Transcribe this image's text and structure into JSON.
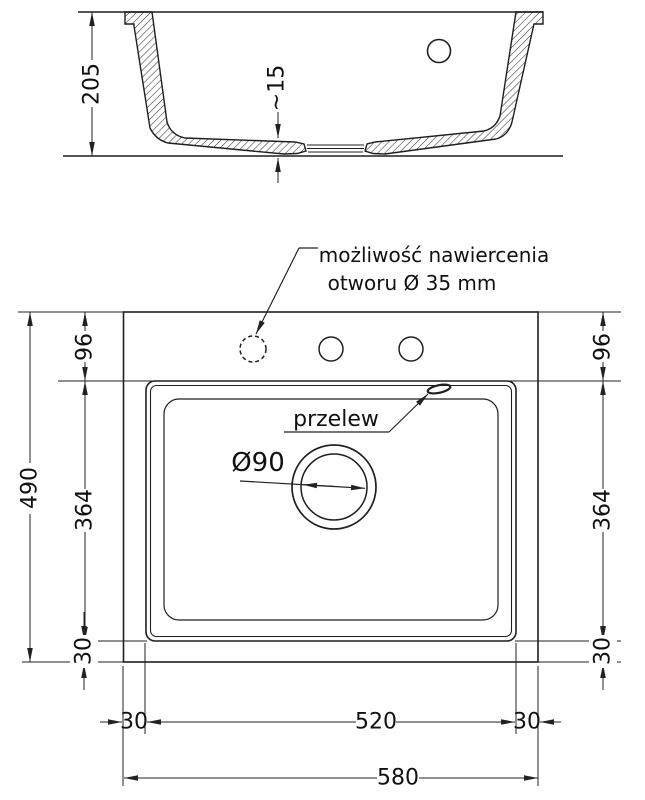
{
  "section_view": {
    "height": "205",
    "floor_thickness": "~15"
  },
  "plan_view": {
    "drill_note_line1": "możliwość nawiercenia",
    "drill_note_line2": "otworu Ø 35 mm",
    "overflow_label": "przelew",
    "drain_diameter_label": "Ø90",
    "dims": {
      "top_strip": "96",
      "bowl_length": "364",
      "bottom_strip": "30",
      "total_length": "490",
      "side_strip": "30",
      "bowl_width": "520",
      "total_width": "580"
    }
  },
  "colors": {
    "line": "#222222",
    "text": "#111111",
    "background": "#ffffff"
  }
}
